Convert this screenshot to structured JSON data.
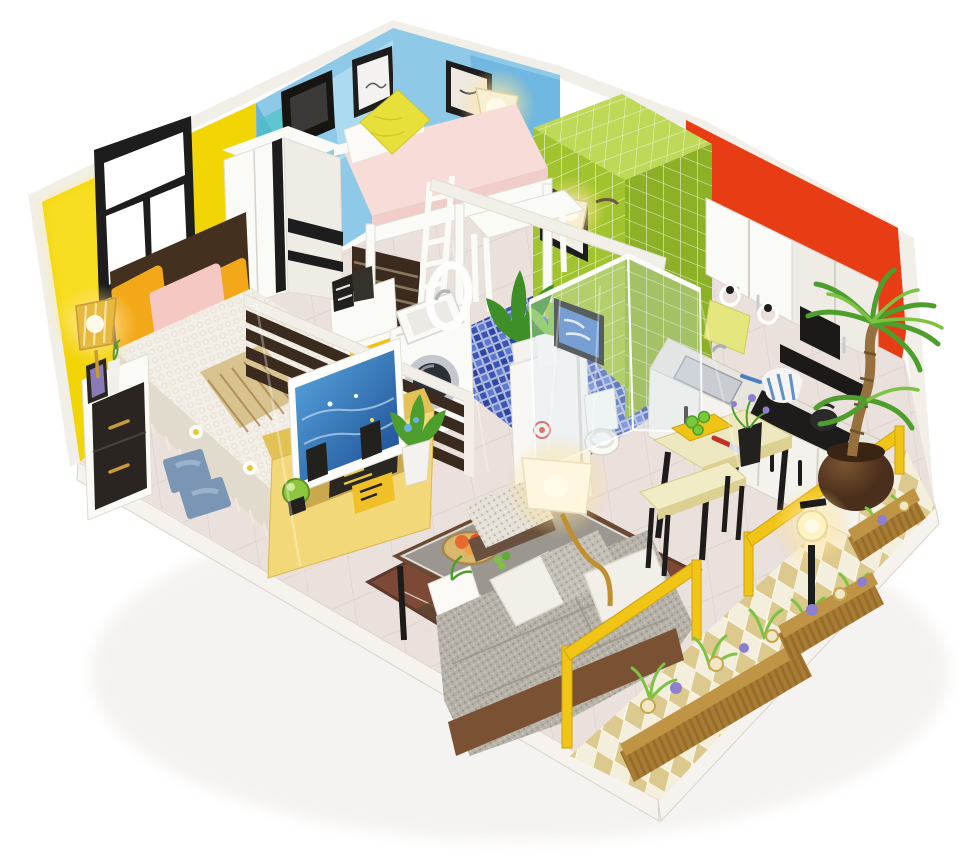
{
  "meta": {
    "title": "Miniature DIY dollhouse diorama of a one-room studio apartment, isometric view on white background",
    "media_type": "photograph",
    "lights_on_count": 5
  },
  "palette": {
    "bg": "#ffffff",
    "trim": "#f2efe9",
    "trimShade": "#ddd7cd",
    "yellowWall": "#f2d504",
    "yellowWallLight": "#ffe94a",
    "blueWallLight": "#8ecae8",
    "blueWallMid": "#57a9da",
    "blueWallTeal": "#47c2c2",
    "blueWallPale": "#b9e1f3",
    "greenTile": "#a1c42e",
    "greenTileLight": "#bed857",
    "greenTileDark": "#8cb026",
    "redWall": "#e83c14",
    "floorMain": "#eae0dc",
    "floorLine": "#d9ccc6",
    "mosaicBlue": "#3c55b4",
    "mosaicBlueLight": "#5d79cf",
    "mosaicBlueDeep": "#2e46a0",
    "balconyTileA": "#f4eedc",
    "balconyTileB": "#dcc98e",
    "platformSide": "#f6f3ef",
    "platformEdge": "#d9d2c8",
    "white": "#fafaf7",
    "offWhite": "#efece6",
    "black": "#222222",
    "frameBlack": "#1d1d1d",
    "darkWood": "#3a2b1e",
    "headboardWood": "#43301f",
    "wood": "#8a5a38",
    "bedBlanket": "#f3efe7",
    "bedBlanketShade": "#e1dbcd",
    "pillowOrange": "#f2a818",
    "pillowPink": "#f6c8c4",
    "pillowYellow": "#e8e03a",
    "mattressPink": "#f8dcd8",
    "nightstandBlack": "#2a2520",
    "handleGold": "#c89a3a",
    "tvYellow": "#f2d878",
    "tvYellowDark": "#e2c155",
    "tvBlue": "#5aa8e0",
    "tvBlueDeep": "#1a4a90",
    "sofaGray": "#b7b2a8",
    "sofaGrayDark": "#99938a",
    "sofaWood": "#7a5233",
    "pillowWhite": "#f2efe8",
    "rugBrown": "#7c4936",
    "rugLine": "#e8ddd2",
    "ottomanKnit": "#e5e0d5",
    "tableCream": "#eee8c0",
    "benchCream": "#f0ecc6",
    "legBlack": "#1e1c1a",
    "counterWhite": "#f4f2ec",
    "counterTopLight": "#e8e5df",
    "stoveBlack": "#1e1c1a",
    "sinkSilver": "#c9cdd2",
    "potBlue": "#4a7ec0",
    "hoodBlack": "#1c1a18",
    "towelYellow": "#e6e67e",
    "fridgeWhite": "#f8f7f4",
    "stickerRed": "#d84030",
    "railYellow": "#f0c515",
    "railYellowDark": "#cfa20e",
    "planterBrown": "#a87c35",
    "planterDark": "#86611f",
    "leafGreen": "#4e9e2e",
    "leafGreenDark": "#3f8f28",
    "leafGreenLight": "#7cc344",
    "flowerPurple": "#8d7fd0",
    "flowerCream": "#f0e6c8",
    "trunkBrown": "#96713d",
    "potDark": "#4a2f1c",
    "glowCore": "#fff8dc",
    "glowWarm": "#ffd978",
    "lampGold": "#c08f2f",
    "lampAmber": "#e8b93f",
    "glass": "rgba(214,230,240,0.32)",
    "glassEdge": "rgba(255,255,255,0.85)",
    "artBlue": "#4a7ec8",
    "paneWhite": "#ffffff",
    "boardYellow": "#f0c414",
    "cucumber": "#7ac837",
    "knifeRed": "#c03028",
    "basketTan": "#d8b86a",
    "fruitOrange": "#e86a30",
    "throwTan": "#d8c28e",
    "throwLine": "#a8854f",
    "slipperBlue": "#7a96b4",
    "shadow": "#c9c2b8"
  },
  "scene": {
    "rooms": [
      {
        "name": "bedroom",
        "wall": "yellow",
        "items": [
          "black framed window",
          "double bed with lace blanket and fringe",
          "orange pillow",
          "pink pillow",
          "dark headboard",
          "striped throw",
          "nightstand with black drawers",
          "lit table lamp",
          "photo frame",
          "blue slippers",
          "wardrobe",
          "dark slatted divider",
          "yellow tv stand",
          "tv with ocean picture",
          "speakers",
          "green orb"
        ]
      },
      {
        "name": "kids-nook",
        "wall": "blue",
        "items": [
          "white loft bed",
          "pink mattress",
          "yellow pillow",
          "white ladder",
          "desk",
          "lit floor lamp",
          "two framed wall prints",
          "dark slat screen"
        ]
      },
      {
        "name": "bathroom",
        "wall": "green-tile",
        "items": [
          "glass shower enclosure",
          "toilet",
          "framed blue art",
          "leaf print",
          "lit wall sconce",
          "washing machine",
          "laundry sink",
          "round mirror",
          "yellow cabinet door",
          "blue porcelain stool",
          "blue mosaic floor",
          "potted plant"
        ]
      },
      {
        "name": "kitchen",
        "wall": "red",
        "items": [
          "white upper cabinets",
          "black range hood",
          "towel rings with yellow towel",
          "counter with sink",
          "striped pot",
          "kettle",
          "dining table",
          "cutting board with cucumber",
          "knife",
          "flower pot",
          "bench"
        ]
      },
      {
        "name": "living-room",
        "items": [
          "gray knit sofa with pillows",
          "wood coffee table with glass top",
          "fruit basket",
          "white ottoman",
          "brown rug",
          "lit floor lamp",
          "fridge with stickers",
          "tall potted plant"
        ]
      },
      {
        "name": "balcony",
        "items": [
          "yellow railing",
          "lit street lamp",
          "three corrugated planter boxes with flowers",
          "potted palm tree",
          "diamond checker tile floor"
        ]
      }
    ]
  }
}
